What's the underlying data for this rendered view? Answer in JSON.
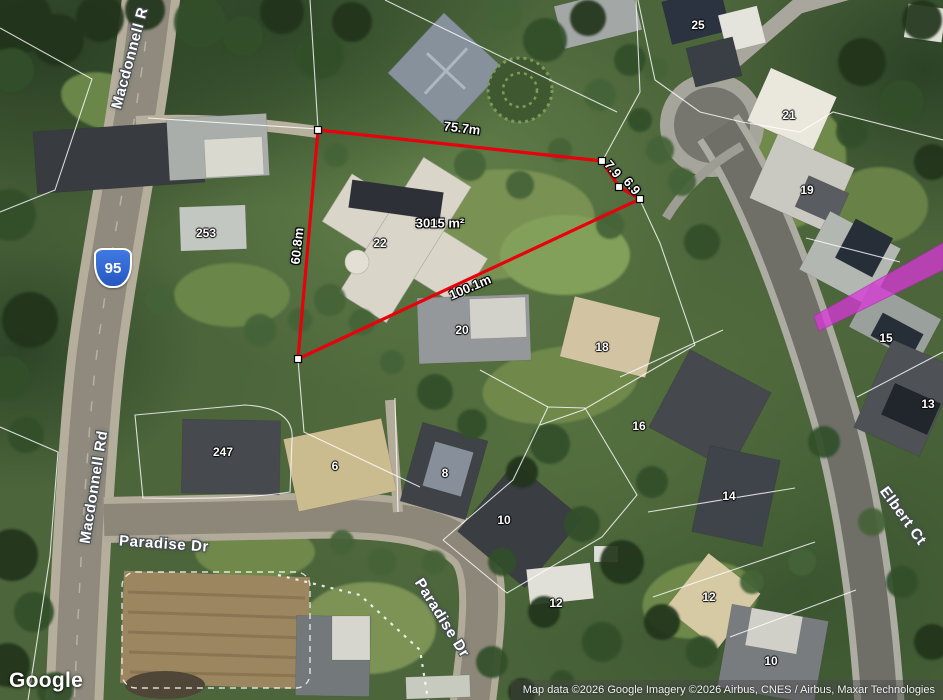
{
  "attribution": {
    "logo": "Google",
    "copyright": "Map data ©2026 Google Imagery ©2026 Airbus, CNES / Airbus, Maxar Technologies"
  },
  "route_shield": {
    "number": "95",
    "color": "#2f63d0"
  },
  "street_labels": [
    {
      "text": "Macdonnell R",
      "x": 130,
      "y": 58,
      "rot": -75
    },
    {
      "text": "Macdonnell Rd",
      "x": 94,
      "y": 487,
      "rot": -81
    },
    {
      "text": "Paradise Dr",
      "x": 164,
      "y": 544,
      "rot": 4
    },
    {
      "text": "Paradise Dr",
      "x": 442,
      "y": 618,
      "rot": 58
    },
    {
      "text": "Elbert Ct",
      "x": 903,
      "y": 516,
      "rot": 54
    }
  ],
  "lot_labels": [
    {
      "text": "253",
      "x": 206,
      "y": 233
    },
    {
      "text": "22",
      "x": 380,
      "y": 243
    },
    {
      "text": "247",
      "x": 223,
      "y": 452
    },
    {
      "text": "6",
      "x": 335,
      "y": 466
    },
    {
      "text": "8",
      "x": 445,
      "y": 473
    },
    {
      "text": "10",
      "x": 504,
      "y": 520
    },
    {
      "text": "12",
      "x": 556,
      "y": 603
    },
    {
      "text": "20",
      "x": 462,
      "y": 330
    },
    {
      "text": "18",
      "x": 602,
      "y": 347
    },
    {
      "text": "16",
      "x": 639,
      "y": 426
    },
    {
      "text": "14",
      "x": 729,
      "y": 496
    },
    {
      "text": "12",
      "x": 709,
      "y": 597
    },
    {
      "text": "10",
      "x": 771,
      "y": 661
    },
    {
      "text": "25",
      "x": 698,
      "y": 25
    },
    {
      "text": "21",
      "x": 789,
      "y": 115
    },
    {
      "text": "19",
      "x": 807,
      "y": 190
    },
    {
      "text": "15",
      "x": 886,
      "y": 338
    },
    {
      "text": "13",
      "x": 928,
      "y": 404
    }
  ],
  "measurement": {
    "area_labels": [
      {
        "text": "3015 m²",
        "x": 440,
        "y": 223,
        "rot": 0
      }
    ],
    "segment_labels": [
      {
        "text": "75.7m",
        "x": 462,
        "y": 128,
        "rot": 7
      },
      {
        "text": "7.9",
        "x": 613,
        "y": 169,
        "rot": 50
      },
      {
        "text": "6.9",
        "x": 632,
        "y": 186,
        "rot": 50
      },
      {
        "text": "100.1m",
        "x": 470,
        "y": 287,
        "rot": -23
      },
      {
        "text": "60.8m",
        "x": 297,
        "y": 246,
        "rot": -84
      }
    ],
    "polygon": {
      "color": "#e8000d",
      "vertices": [
        [
          318,
          130
        ],
        [
          602,
          161
        ],
        [
          619,
          187
        ],
        [
          640,
          199
        ],
        [
          298,
          359
        ]
      ]
    }
  },
  "highlight": {
    "color": "#d935d9",
    "points": [
      [
        814,
        316
      ],
      [
        943,
        243
      ],
      [
        943,
        270
      ],
      [
        819,
        331
      ]
    ]
  }
}
